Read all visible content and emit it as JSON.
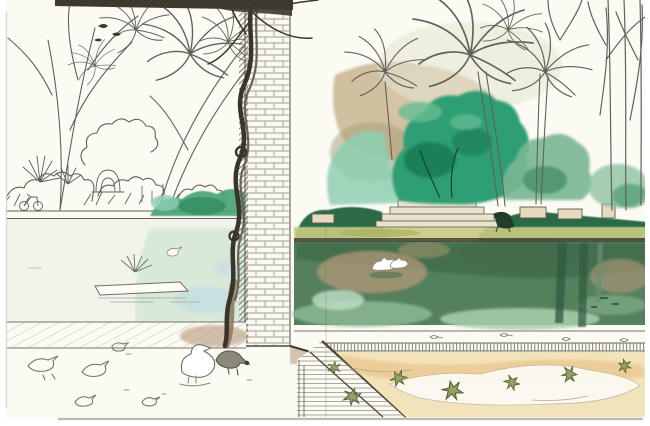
{
  "artwork": {
    "alt": "Ink and watercolor sketchbook drawing of a park: a long pond with a dark three-tier fountain on the far bank, palm trees and emerald bushes, a white brick pillar with a twisted tree trunk in the foreground, pigeons on pale pavement, two white birds swimming on deep green water, and fallen star-shaped leaves on a sandy corner."
  },
  "objects": {
    "page": "watercolor sketchbook page",
    "beam": "pergola roof beam",
    "column": "white brick pillar",
    "vine": "twisted tree trunk climbing the pillar",
    "left_trees": "ink-drawn park trees and palm fronds",
    "right_palms": "palm trees behind the fountain",
    "bare_branches": "bare branches at top right",
    "wall": "tan garden wall",
    "fountain": "three-tier dark stone fountain",
    "person": "visitor standing by the fountain",
    "hedges": "clipped dark hedges on the far bank",
    "grass": "yellow-green grass strip",
    "benches": "stone benches and planters",
    "pond": "park pond",
    "swans": "two white birds on the water",
    "island": "small planted raft in the pond",
    "reflections": "palm trunk reflections in the water",
    "walkway": "hatched tile walkway at the pond edge",
    "pavement": "striped pavement wedge",
    "sand": "sandy ground with fallen leaves",
    "leaves": "fallen star-shaped leaves",
    "pigeons": "pigeons sketched on the ground",
    "duck": "white duck in the foreground",
    "bicycle": "tiny bicycle doodle at the far bank",
    "crease": "sketchbook center crease"
  },
  "palette": {
    "margin": "#ffffff",
    "paper": "#fbfaf3",
    "ink": "#63605a",
    "ink_dark": "#3b3831",
    "beam": "#423d33",
    "brick_fill": "#f9f8f1",
    "brick_line": "#a29e92",
    "column_edge": "#4b463d",
    "vine": "#3a352c",
    "trunk_wash": "#8a7660",
    "wall_tan": "#c3ac83",
    "wall_olive": "#a59e74",
    "teal_bush": "#8ecfb2",
    "bush_emerald": "#2f9e74",
    "bush_dark": "#187a50",
    "bush_light": "#66bd94",
    "bush_pale": "#7ab794",
    "hedge_green": "#46a375",
    "hedge_dark": "#2c6a46",
    "grass_yellow": "#c9cc82",
    "stone": "#eae2cd",
    "fountain": "#342a1e",
    "figure": "#4a4034",
    "water_pale": "#f2f4ea",
    "water_tint": "#d4e8d6",
    "water_blue": "#c3dde6",
    "water_deep": "#55805e",
    "water_dark": "#3f6b4a",
    "water_tan": "#b29878",
    "water_light": "#a9cfae",
    "reflection": "#2e5a40",
    "swan": "#ffffff",
    "rim": "#4a463a",
    "sand": "#f3e3ba",
    "sand_deep": "#eac389",
    "sand_pale": "#fcfaf2",
    "leaf": "#93a164",
    "leaf_dark": "#57613a",
    "shadow_tan": "#b6997a",
    "page_edge": "#8a8376"
  }
}
